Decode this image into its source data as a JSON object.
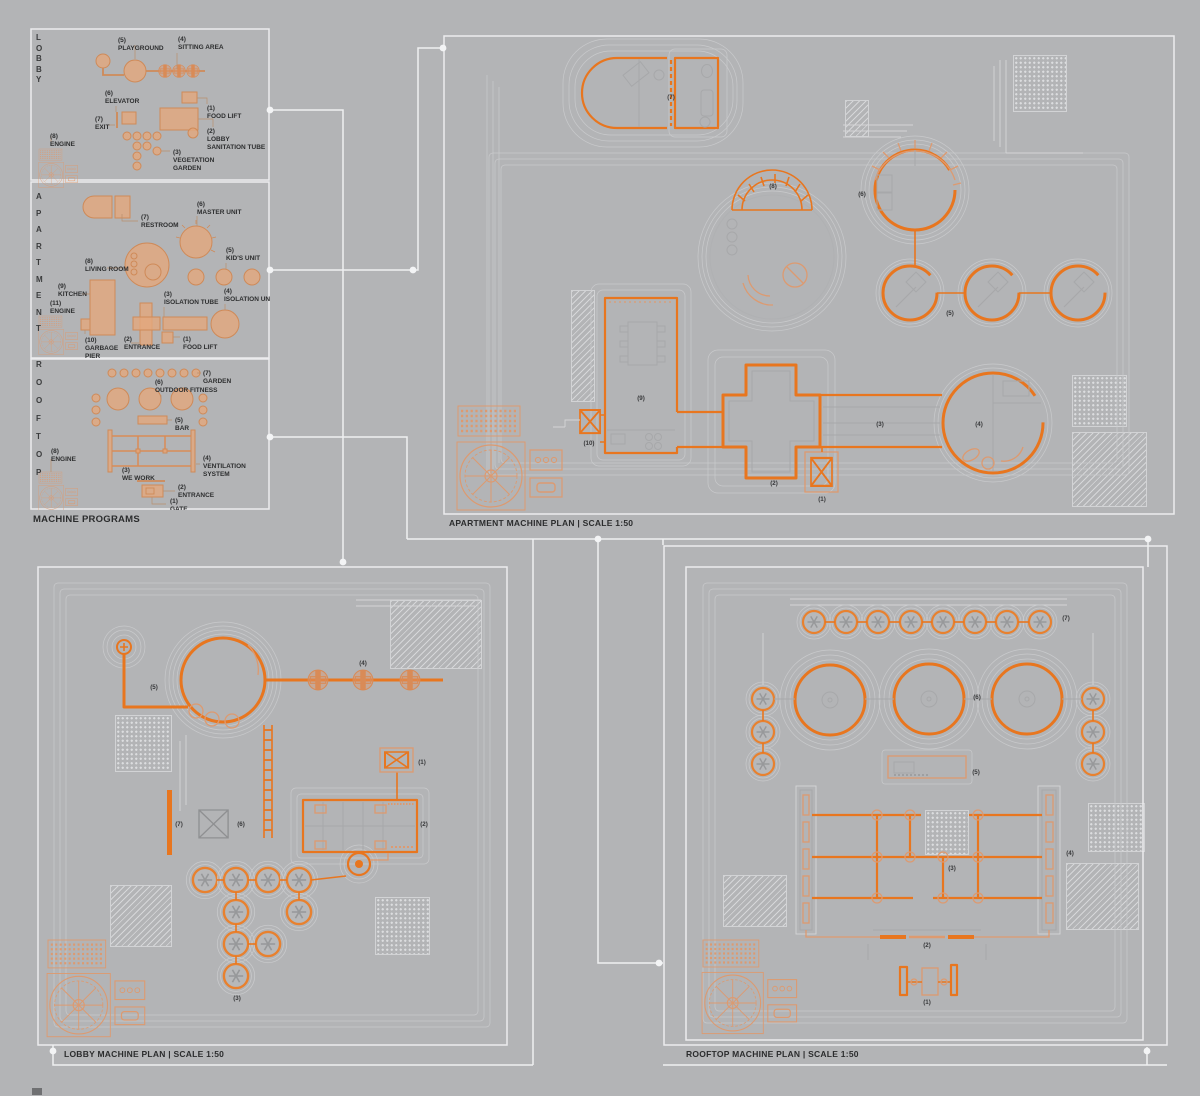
{
  "colors": {
    "background": "#b3b4b6",
    "accent": "#e8761f",
    "accent_light": "#dd9a70",
    "line_white": "#ececee",
    "line_gray": "#c9cacc",
    "text": "#2d2e2f"
  },
  "legend": {
    "caption": "MACHINE PROGRAMS",
    "sections": [
      {
        "title": "LOBBY",
        "items": [
          {
            "num": "(5)",
            "lines": [
              "PLAYGROUND"
            ]
          },
          {
            "num": "(4)",
            "lines": [
              "SITTING AREA"
            ]
          },
          {
            "num": "(6)",
            "lines": [
              "ELEVATOR"
            ]
          },
          {
            "num": "(7)",
            "lines": [
              "EXIT"
            ]
          },
          {
            "num": "(1)",
            "lines": [
              "FOOD LIFT"
            ]
          },
          {
            "num": "(2)",
            "lines": [
              "LOBBY",
              "SANITATION TUBE"
            ]
          },
          {
            "num": "(8)",
            "lines": [
              "ENGINE"
            ]
          },
          {
            "num": "(3)",
            "lines": [
              "VEGETATION",
              "GARDEN"
            ]
          }
        ]
      },
      {
        "title": "APARTMENT",
        "items": [
          {
            "num": "(7)",
            "lines": [
              "RESTROOM"
            ]
          },
          {
            "num": "(6)",
            "lines": [
              "MASTER UNIT"
            ]
          },
          {
            "num": "(8)",
            "lines": [
              "LIVING ROOM"
            ]
          },
          {
            "num": "(5)",
            "lines": [
              "KID'S UNIT"
            ]
          },
          {
            "num": "(9)",
            "lines": [
              "KITCHEN"
            ]
          },
          {
            "num": "(3)",
            "lines": [
              "ISOLATION TUBE"
            ]
          },
          {
            "num": "(4)",
            "lines": [
              "ISOLATION UNIT"
            ]
          },
          {
            "num": "(11)",
            "lines": [
              "ENGINE"
            ]
          },
          {
            "num": "(10)",
            "lines": [
              "GARBAGE",
              "PIER"
            ]
          },
          {
            "num": "(2)",
            "lines": [
              "ENTRANCE"
            ]
          },
          {
            "num": "(1)",
            "lines": [
              "FOOD LIFT"
            ]
          }
        ]
      },
      {
        "title": "ROOFTOP",
        "items": [
          {
            "num": "(7)",
            "lines": [
              "GARDEN"
            ]
          },
          {
            "num": "(6)",
            "lines": [
              "OUTDOOR FITNESS"
            ]
          },
          {
            "num": "(5)",
            "lines": [
              "BAR"
            ]
          },
          {
            "num": "(8)",
            "lines": [
              "ENGINE"
            ]
          },
          {
            "num": "(3)",
            "lines": [
              "WE WORK"
            ]
          },
          {
            "num": "(4)",
            "lines": [
              "VENTILATION",
              "SYSTEM"
            ]
          },
          {
            "num": "(2)",
            "lines": [
              "ENTRANCE"
            ]
          },
          {
            "num": "(1)",
            "lines": [
              "GATE"
            ]
          }
        ]
      }
    ]
  },
  "plans": {
    "apartment": {
      "caption": "APARTMENT MACHINE PLAN | SCALE 1:50",
      "marks": [
        "(1)",
        "(2)",
        "(3)",
        "(4)",
        "(5)",
        "(6)",
        "(7)",
        "(8)",
        "(9)",
        "(10)"
      ]
    },
    "lobby": {
      "caption": "LOBBY MACHINE PLAN | SCALE 1:50",
      "marks": [
        "(1)",
        "(2)",
        "(3)",
        "(4)",
        "(5)",
        "(6)",
        "(7)"
      ]
    },
    "rooftop": {
      "caption": "ROOFTOP MACHINE PLAN | SCALE 1:50",
      "marks": [
        "(1)",
        "(2)",
        "(3)",
        "(4)",
        "(5)",
        "(6)",
        "(7)"
      ]
    }
  }
}
